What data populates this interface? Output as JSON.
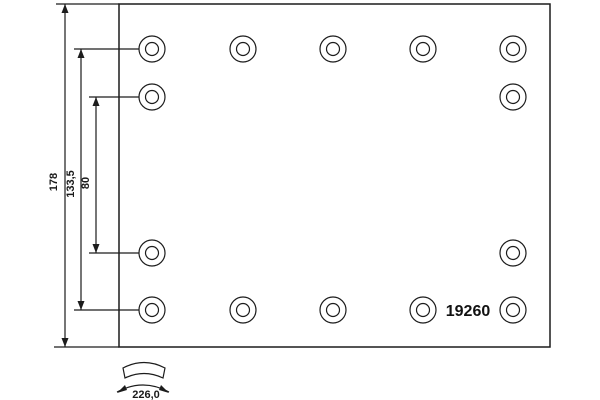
{
  "drawing": {
    "type": "brake-lining-technical-drawing",
    "part_number": "19260",
    "dimensions": {
      "overall_width": "178",
      "outer_rivet_row_spacing": "133,5",
      "inner_rivet_row_spacing": "80",
      "arc_width": "226,0"
    },
    "holes": {
      "total": 14,
      "rows": [
        {
          "position": "top",
          "count": 5
        },
        {
          "position": "upper-inner",
          "count": 2
        },
        {
          "position": "lower-inner",
          "count": 2
        },
        {
          "position": "bottom",
          "count": 5
        }
      ]
    },
    "colors": {
      "line": "#1c1c1c",
      "background": "#ffffff"
    }
  }
}
